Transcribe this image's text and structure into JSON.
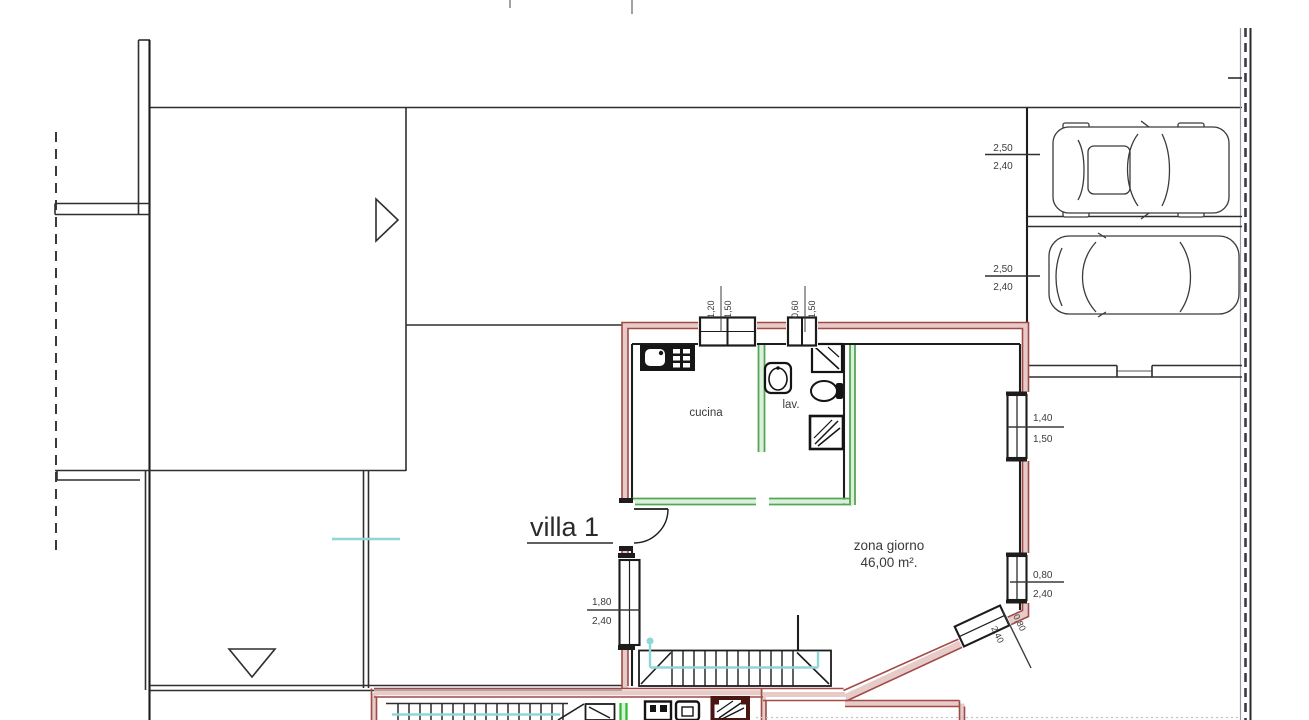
{
  "plan": {
    "villa_label": "villa 1",
    "rooms": {
      "cucina": "cucina",
      "lav": "lav.",
      "zona_giorno_name": "zona giorno",
      "zona_giorno_area": "46,00 m²."
    },
    "dims": {
      "parking1_a": "2,50",
      "parking1_b": "2,40",
      "parking2_a": "2,50",
      "parking2_b": "2,40",
      "win_top1_a": "1,20",
      "win_top1_b": "1,50",
      "win_top2_a": "0,60",
      "win_top2_b": "1,50",
      "win_right1_a": "1,40",
      "win_right1_b": "1,50",
      "win_right2_a": "0,80",
      "win_right2_b": "2,40",
      "win_left_a": "1,80",
      "win_left_b": "2,40",
      "win_diag_a": "0,80",
      "win_diag_b": "2,40"
    },
    "icons": {
      "car1": "car-top-view",
      "car2": "car-top-view",
      "triangle_right": "direction-marker",
      "triangle_down": "direction-marker"
    },
    "colors": {
      "wall_red": "#a14a46",
      "wall_fill_pink": "#e6cbc9",
      "partition_green": "#52a852",
      "bright_green": "#2eb82e",
      "path_cyan": "#8ed7d4",
      "line_dark": "#2f2f2f"
    }
  }
}
